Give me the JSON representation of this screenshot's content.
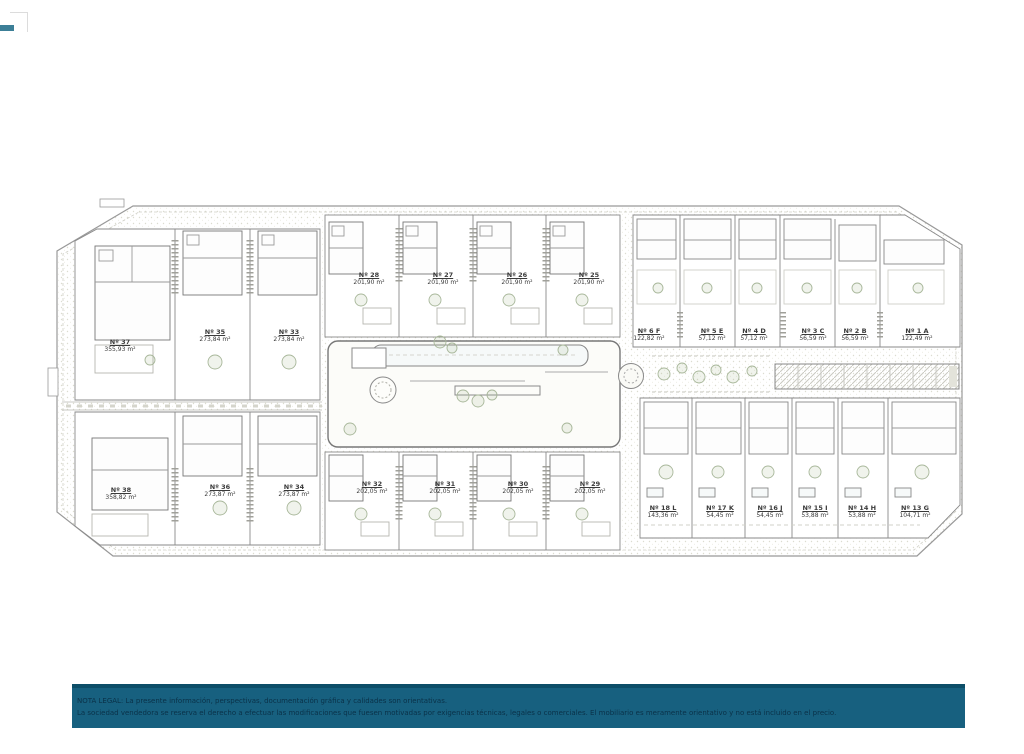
{
  "corner_mark": {
    "color": "#3c7f97"
  },
  "site_plan": {
    "units": [
      {
        "id": "Nº 37",
        "area": "355,93 m²",
        "x": 120,
        "y": 338
      },
      {
        "id": "Nº 35",
        "area": "273,84 m²",
        "x": 215,
        "y": 328
      },
      {
        "id": "Nº 33",
        "area": "273,84 m²",
        "x": 289,
        "y": 328
      },
      {
        "id": "Nº 28",
        "area": "201,90 m²",
        "x": 369,
        "y": 271
      },
      {
        "id": "Nº 27",
        "area": "201,90 m²",
        "x": 443,
        "y": 271
      },
      {
        "id": "Nº 26",
        "area": "201,90 m²",
        "x": 517,
        "y": 271
      },
      {
        "id": "Nº 25",
        "area": "201,90 m²",
        "x": 589,
        "y": 271
      },
      {
        "id": "Nº 6 F",
        "area": "122,82 m²",
        "x": 649,
        "y": 327
      },
      {
        "id": "Nº 5 E",
        "area": "57,12 m²",
        "x": 712,
        "y": 327
      },
      {
        "id": "Nº 4 D",
        "area": "57,12 m²",
        "x": 754,
        "y": 327
      },
      {
        "id": "Nº 3 C",
        "area": "56,59 m²",
        "x": 813,
        "y": 327
      },
      {
        "id": "Nº 2 B",
        "area": "56,59 m²",
        "x": 855,
        "y": 327
      },
      {
        "id": "Nº 1 A",
        "area": "122,49 m²",
        "x": 917,
        "y": 327
      },
      {
        "id": "Nº 38",
        "area": "358,82 m²",
        "x": 121,
        "y": 486
      },
      {
        "id": "Nº 36",
        "area": "273,87 m²",
        "x": 220,
        "y": 483
      },
      {
        "id": "Nº 34",
        "area": "273,87 m²",
        "x": 294,
        "y": 483
      },
      {
        "id": "Nº 32",
        "area": "202,05 m²",
        "x": 372,
        "y": 480
      },
      {
        "id": "Nº 31",
        "area": "202,05 m²",
        "x": 445,
        "y": 480
      },
      {
        "id": "Nº 30",
        "area": "202,05 m²",
        "x": 518,
        "y": 480
      },
      {
        "id": "Nº 29",
        "area": "202,05 m²",
        "x": 590,
        "y": 480
      },
      {
        "id": "Nº 18 L",
        "area": "143,36 m²",
        "x": 663,
        "y": 504
      },
      {
        "id": "Nº 17 K",
        "area": "54,45 m²",
        "x": 720,
        "y": 504
      },
      {
        "id": "Nº 16 J",
        "area": "54,45 m²",
        "x": 770,
        "y": 504
      },
      {
        "id": "Nº 15 I",
        "area": "53,88 m²",
        "x": 815,
        "y": 504
      },
      {
        "id": "Nº 14 H",
        "area": "53,88 m²",
        "x": 862,
        "y": 504
      },
      {
        "id": "Nº 13 G",
        "area": "104,71 m²",
        "x": 915,
        "y": 504
      }
    ]
  },
  "legal_note": {
    "bg_color": "#17607f",
    "top_border_color": "#0d4e68",
    "text_color": "#0a3148",
    "line1": "NOTA LEGAL: La presente información, perspectivas, documentación gráfica y calidades son orientativas.",
    "line2": "La sociedad vendedora se reserva el derecho a efectuar las modificaciones que fuesen motivadas por exigencias técnicas, legales o comerciales. El mobiliario es meramente orientativo y no está incluido en el precio."
  }
}
